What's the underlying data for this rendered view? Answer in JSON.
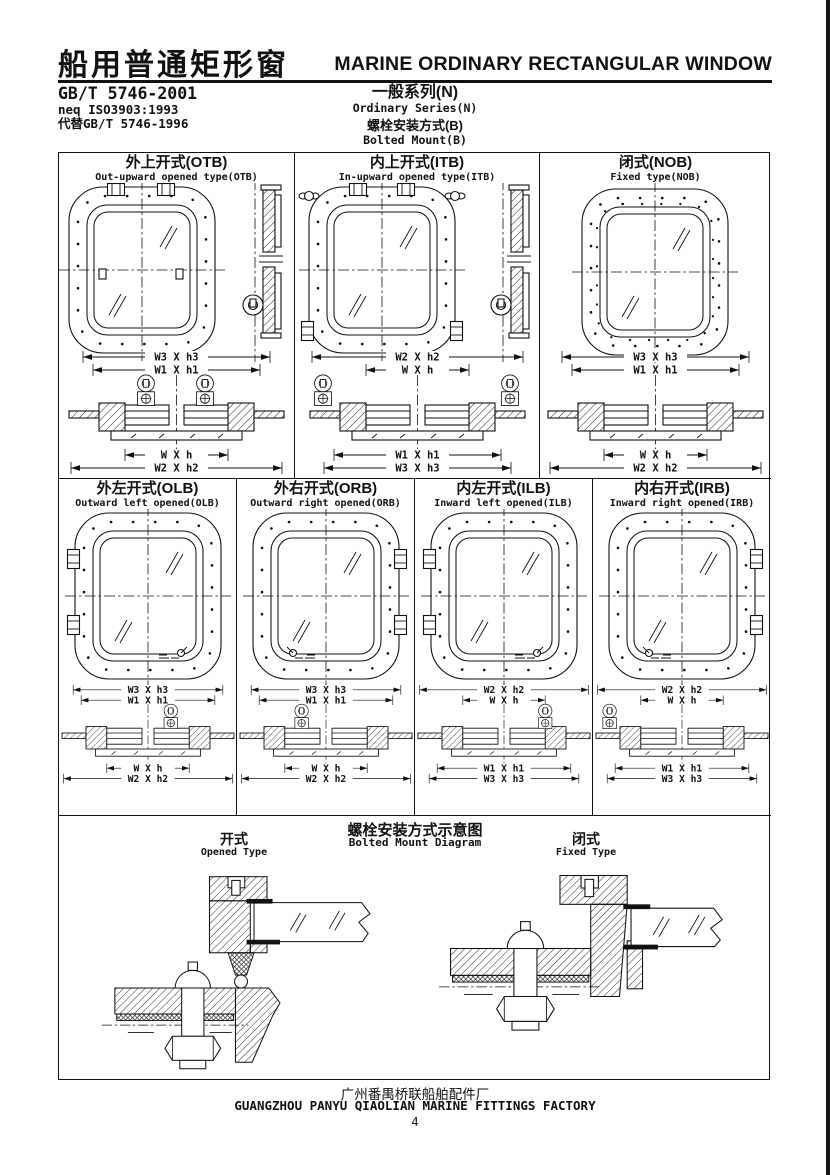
{
  "header": {
    "title_cn": "船用普通矩形窗",
    "title_en": "MARINE ORDINARY RECTANGULAR WINDOW",
    "standards": [
      "GB/T 5746-2001",
      "neq ISO3903:1993",
      "代替GB/T 5746-1996"
    ],
    "series_cn": "一般系列(N)",
    "series_en": "Ordinary Series(N)",
    "mount_cn": "螺栓安装方式(B)",
    "mount_en": "Bolted Mount(B)"
  },
  "cells_row1": [
    {
      "title_cn": "外上开式(OTB)",
      "title_en": "Out-upward opened type(OTB)",
      "dims": [
        "W3 X h3",
        "W1 X h1",
        "W X h",
        "W2 X h2"
      ]
    },
    {
      "title_cn": "内上开式(ITB)",
      "title_en": "In-upward opened type(ITB)",
      "dims": [
        "W2 X h2",
        "W X h",
        "W1 X h1",
        "W3 X h3"
      ]
    },
    {
      "title_cn": "闭式(NOB)",
      "title_en": "Fixed type(NOB)",
      "dims": [
        "W3 X h3",
        "W1 X h1",
        "W X h",
        "W2 X h2"
      ]
    }
  ],
  "cells_row2": [
    {
      "title_cn": "外左开式(OLB)",
      "title_en": "Outward left opened(OLB)",
      "dims": [
        "W3 X h3",
        "W1 X h1",
        "W X h",
        "W2 X h2"
      ]
    },
    {
      "title_cn": "外右开式(ORB)",
      "title_en": "Outward right opened(ORB)",
      "dims": [
        "W3 X h3",
        "W1 X h1",
        "W X h",
        "W2 X h2"
      ]
    },
    {
      "title_cn": "内左开式(ILB)",
      "title_en": "Inward left opened(ILB)",
      "dims": [
        "W2 X h2",
        "W X h",
        "W1 X h1",
        "W3 X h3"
      ]
    },
    {
      "title_cn": "内右开式(IRB)",
      "title_en": "Inward right opened(IRB)",
      "dims": [
        "W2 X h2",
        "W X h",
        "W1 X h1",
        "W3 X h3"
      ]
    }
  ],
  "mount_diagram": {
    "title_cn": "螺栓安装方式示意图",
    "title_en": "Bolted Mount Diagram",
    "opened_cn": "开式",
    "opened_en": "Opened Type",
    "fixed_cn": "闭式",
    "fixed_en": "Fixed Type"
  },
  "footer": {
    "factory_cn": "广州番禺桥联船舶配件厂",
    "factory_en": "GUANGZHOU PANYU QIAOLIAN MARINE FITTINGS FACTORY",
    "page_number": "4"
  }
}
